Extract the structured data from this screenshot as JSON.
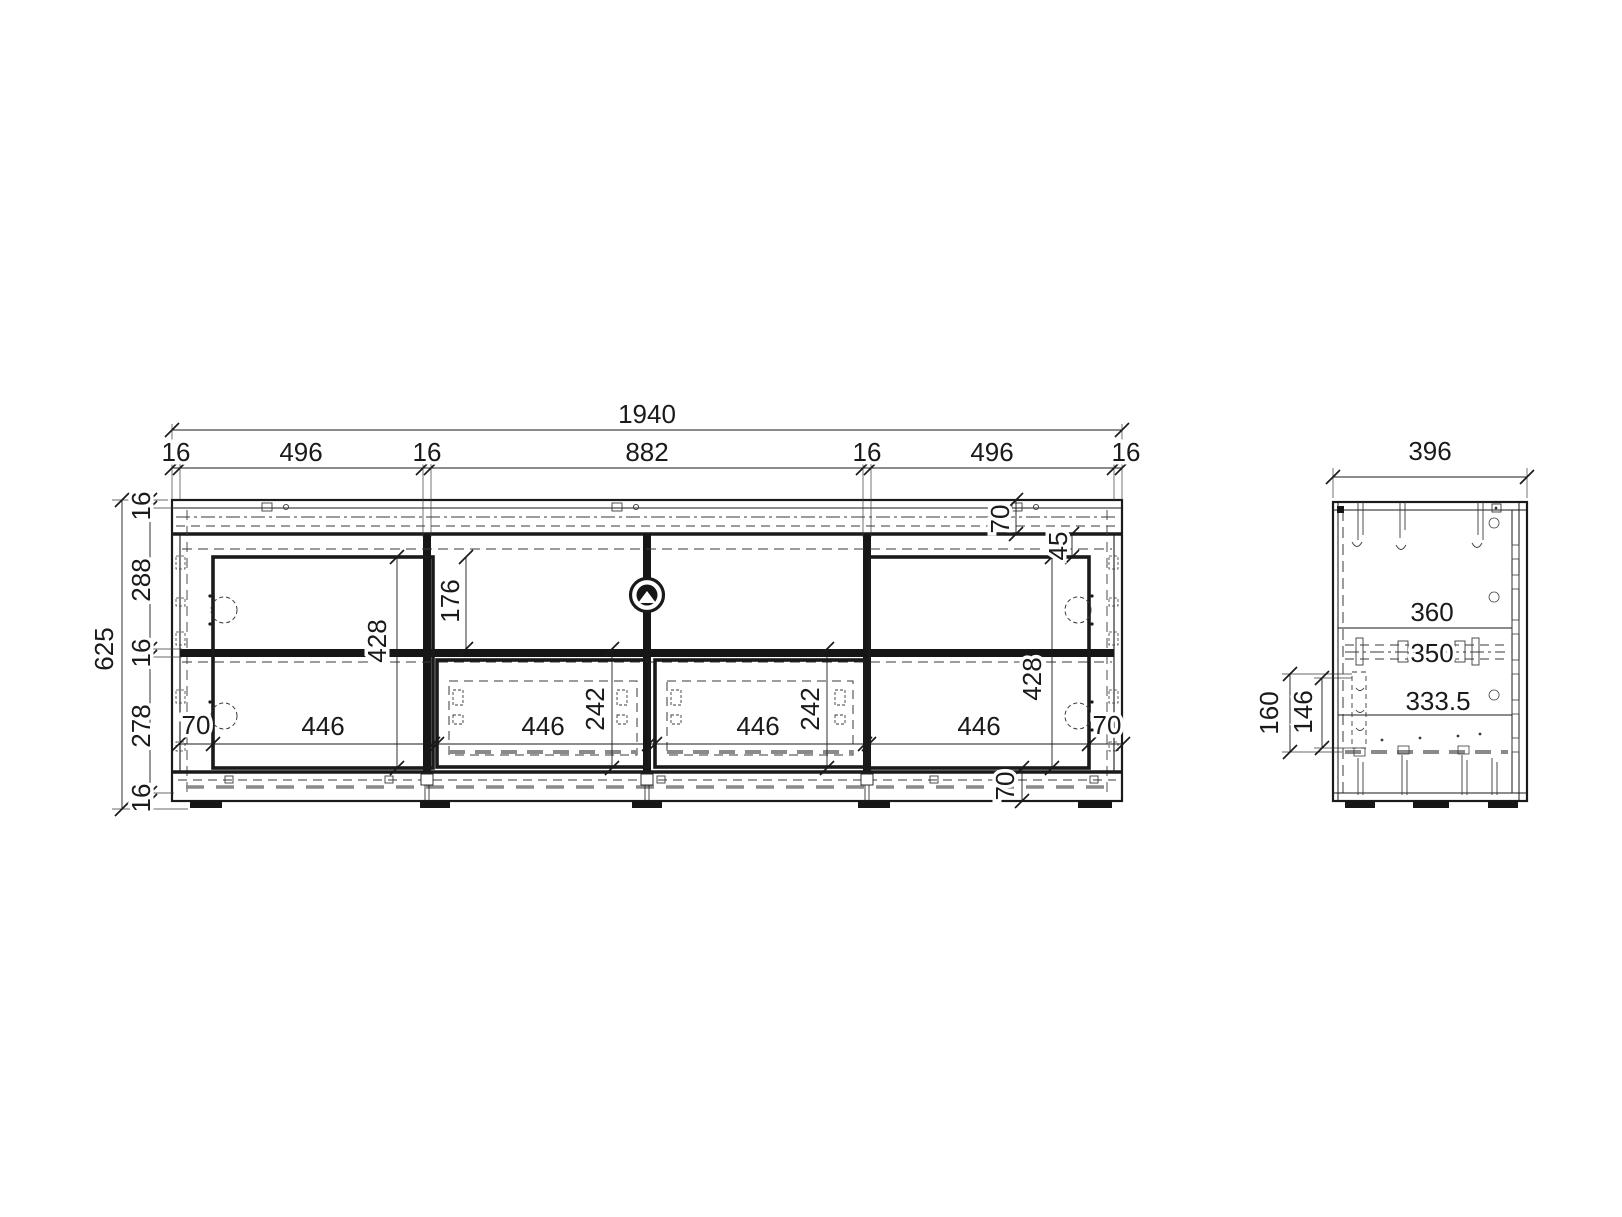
{
  "front_view": {
    "overall_width": "1940",
    "width_chain": [
      "16",
      "496",
      "16",
      "882",
      "16",
      "496",
      "16"
    ],
    "overall_height": "625",
    "height_chain": [
      "16",
      "288",
      "16",
      "278",
      "16"
    ],
    "open_compartment_height": "176",
    "door_heights": [
      "428",
      "428"
    ],
    "drawer_heights": [
      "242",
      "242"
    ],
    "compartment_widths": [
      "446",
      "446",
      "446",
      "446"
    ],
    "left_edge_offset": "70",
    "right_edge_offset": "70",
    "top_rail_height": "70",
    "door_top_offset": "45",
    "plinth_height": "70"
  },
  "side_view": {
    "overall_depth": "396",
    "top_depth": "360",
    "rail_depth": "350",
    "inner_depth": "333.5",
    "bracket_heights": [
      "160",
      "146"
    ]
  },
  "colors": {
    "line": "#1a1a1a",
    "hidden_line": "#3a3a3a",
    "runner_dash": "#8a8a8a",
    "background": "#ffffff"
  }
}
